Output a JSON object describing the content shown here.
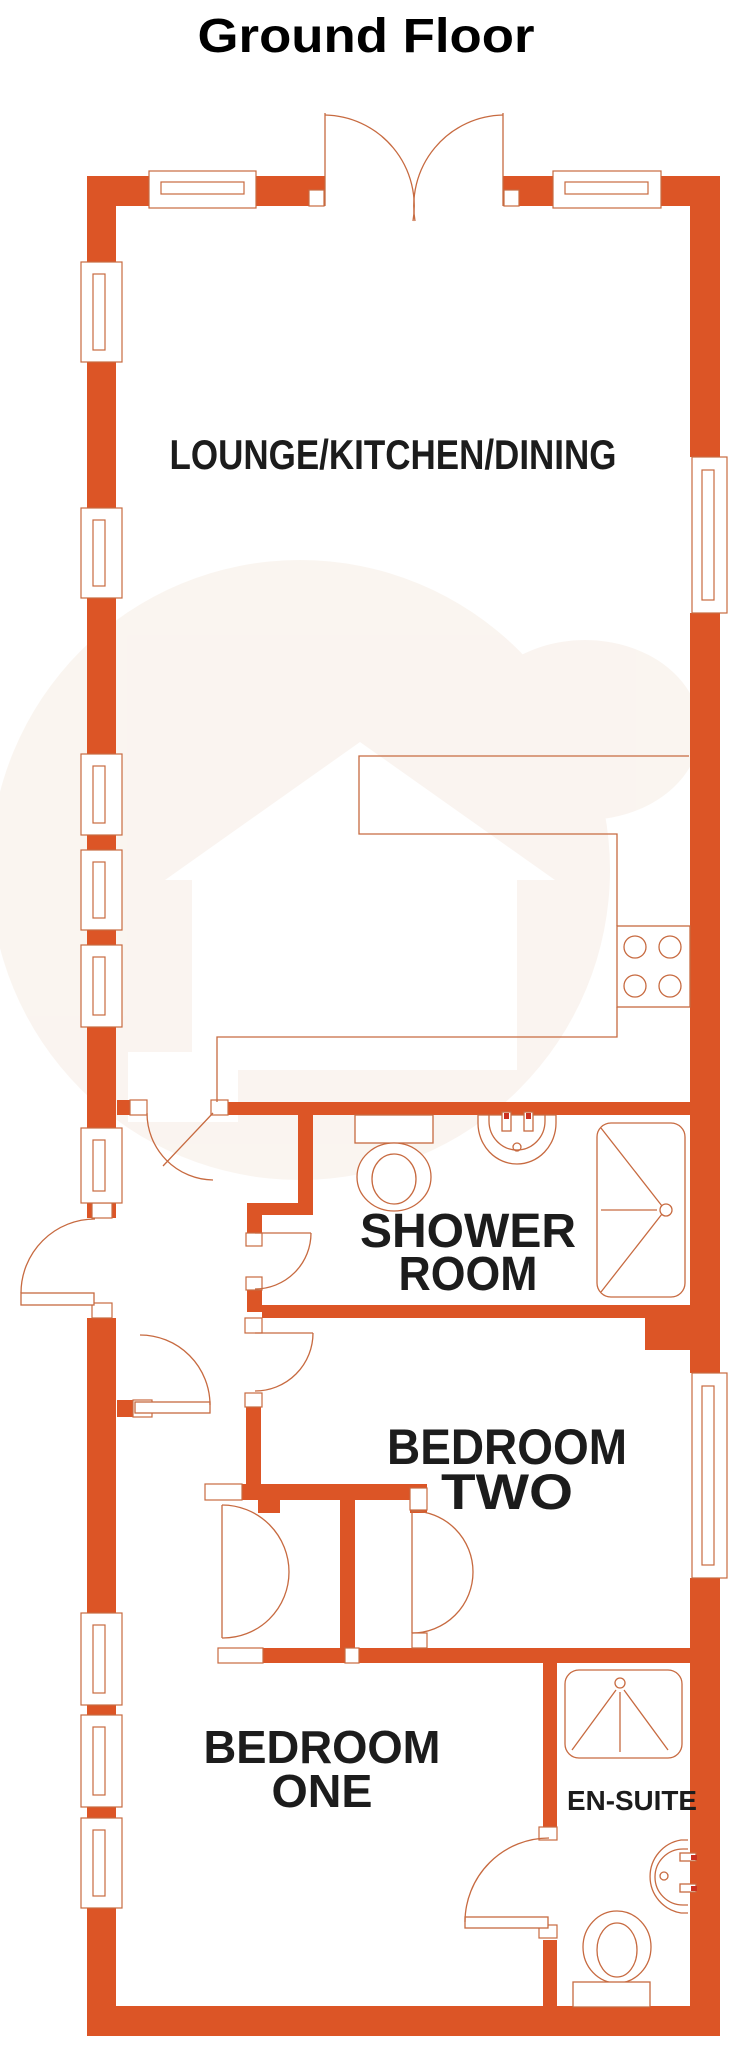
{
  "title": "Ground Floor",
  "colors": {
    "wall": "#DC5526",
    "line": "#C76A40",
    "text": "#1C1C1C",
    "tap": "#CC3120",
    "watermark": "#F6ECE4"
  },
  "rooms": {
    "lounge_kitchen_dining": {
      "label": "LOUNGE/KITCHEN/DINING"
    },
    "shower_room": {
      "label": "SHOWER ROOM",
      "line1": "SHOWER",
      "line2": "ROOM"
    },
    "bedroom_two": {
      "label": "BEDROOM TWO",
      "line1": "BEDROOM",
      "line2": "TWO"
    },
    "bedroom_one": {
      "label": "BEDROOM ONE",
      "line1": "BEDROOM",
      "line2": "ONE"
    },
    "ensuite": {
      "label": "EN-SUITE"
    }
  },
  "fixtures": {
    "kitchen": [
      "worktop",
      "hob"
    ],
    "shower_room": [
      "toilet",
      "basin",
      "shower-enclosure"
    ],
    "ensuite": [
      "shower-enclosure",
      "basin",
      "toilet"
    ],
    "storage": [
      "wardrobe-left",
      "wardrobe-right"
    ]
  }
}
